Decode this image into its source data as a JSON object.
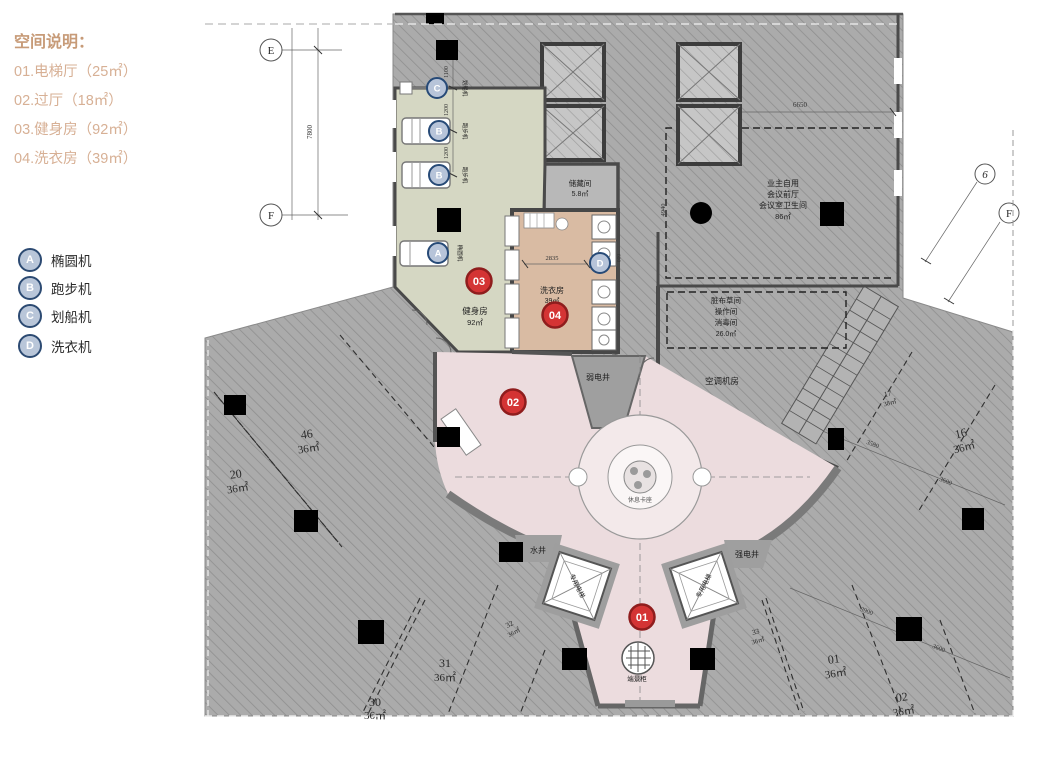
{
  "legend": {
    "title": "空间说明：",
    "items": [
      "01.电梯厅（25㎡）",
      "02.过厅（18㎡）",
      "03.健身房（92㎡）",
      "04.洗衣房（39㎡）"
    ],
    "equipment": [
      {
        "key": "A",
        "label": "椭圆机"
      },
      {
        "key": "B",
        "label": "跑步机"
      },
      {
        "key": "C",
        "label": "划船机"
      },
      {
        "key": "D",
        "label": "洗衣机"
      }
    ]
  },
  "plan": {
    "markers": {
      "m01": "01",
      "m02": "02",
      "m03": "03",
      "m04": "04",
      "a": "A",
      "b": "B",
      "c": "C",
      "d": "D"
    },
    "rooms": {
      "gym_name": "健身房",
      "gym_area": "92㎡",
      "laundry_name": "洗衣房",
      "laundry_area": "39㎡",
      "storage_name": "储藏间",
      "storage_area": "5.8㎡",
      "meeting_lines": [
        "业主自用",
        "会议前厅",
        "会议室卫生间",
        "86㎡"
      ],
      "linen_lines": [
        "脏布草间",
        "操作间",
        "消毒间",
        "26.0㎡"
      ],
      "ac_room": "空调机房",
      "weak_shaft": "弱电井",
      "strong_shaft": "强电井",
      "water_shaft": "水井",
      "rest_seat": "休息卡座",
      "end_cabinet": "端景柜",
      "private_elevator": "专用电梯"
    },
    "machines": {
      "rowing": "划船机",
      "treadmill": "跑步机",
      "elliptical": "椭圆机"
    },
    "units": [
      {
        "no": "20",
        "area": "36㎡"
      },
      {
        "no": "46",
        "area": "36㎡"
      },
      {
        "no": "30",
        "area": "36㎡"
      },
      {
        "no": "31",
        "area": "36㎡"
      },
      {
        "no": "32",
        "area": "36㎡"
      },
      {
        "no": "33",
        "area": "36㎡"
      },
      {
        "no": "01",
        "area": "36㎡"
      },
      {
        "no": "02",
        "area": "36㎡"
      },
      {
        "no": "16",
        "area": "36㎡"
      },
      {
        "no": "17",
        "area": "38㎡"
      }
    ],
    "dims": {
      "ef": "7800",
      "top_meeting": "6650",
      "left_meeting": "4940",
      "laundry": "2835",
      "washer": "600",
      "gym1": "1100",
      "gym2": "1200",
      "gym3": "1200",
      "r1": "3580",
      "r2": "3600",
      "r3": "3900",
      "r4": "3600"
    },
    "axes": {
      "e": "E",
      "f": "F",
      "six": "6",
      "f_right": "F"
    }
  },
  "colors": {
    "legend_title": "#c79b78",
    "legend_item": "#d7b095",
    "gym": "#d5d7c3",
    "laundry": "#d9bba3",
    "lobby": "#ecdcde",
    "hatch": "#ababab",
    "marker_red": "#d43434",
    "marker_navy": "#274a77"
  }
}
